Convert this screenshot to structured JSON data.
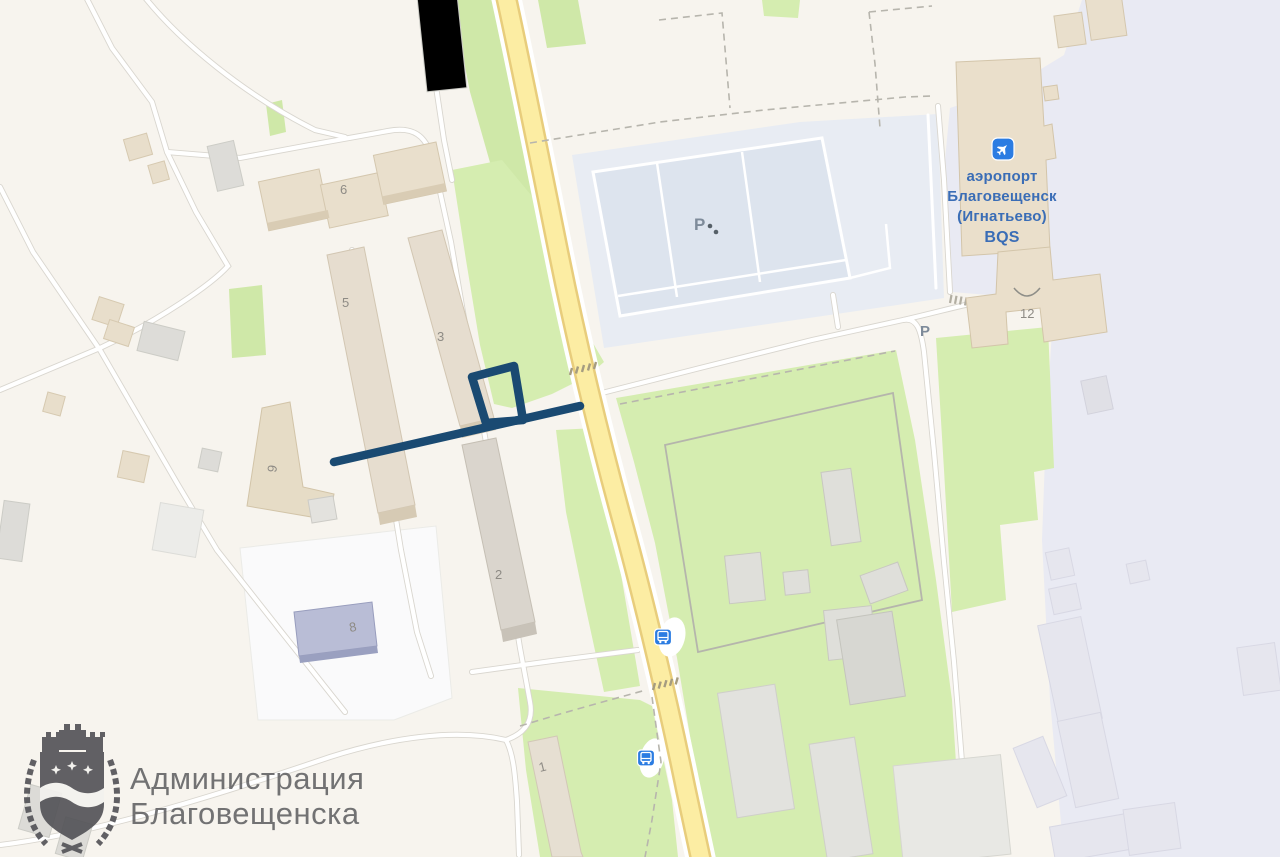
{
  "map": {
    "building_labels": {
      "b6": "6",
      "b5": "5",
      "b3": "3",
      "b9": "9",
      "b2": "2",
      "b8": "8",
      "b1": "1",
      "b12": "12"
    },
    "parking_labels": {
      "main": "P",
      "east": "P"
    },
    "airport_label": {
      "line1": "аэропорт",
      "line2": "Благовещенск",
      "line3": "(Игнатьево)",
      "line4": "BQS"
    },
    "icons": {
      "airport": "airplane-icon",
      "bus_stop": "bus-stop-icon"
    },
    "annotation": {
      "type": "route-highlight",
      "color": "#1a4a72"
    },
    "colors": {
      "base": "#f7f4ee",
      "airport_grounds": "#e9eaf3",
      "green": "#d5edb0",
      "parking_pad": "#e8ecf3",
      "parking_lot": "#dde4ee",
      "road_major_fill": "#fceda3",
      "road_major_casing": "#e8cd7c",
      "poi_blue": "#2b7ce2",
      "airport_text": "#3a6db6",
      "route": "#1a4a72"
    },
    "watermark": {
      "line1": "Администрация",
      "line2": "Благовещенска"
    }
  }
}
